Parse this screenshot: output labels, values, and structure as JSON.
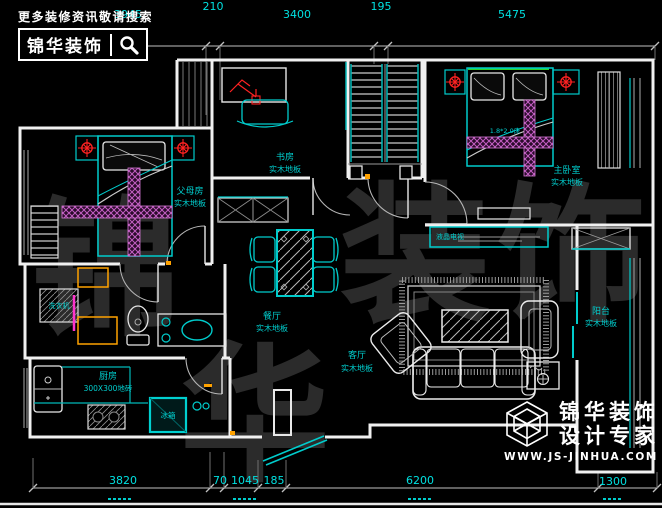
{
  "branding_top": {
    "tagline": "更多装修资讯敬请搜索",
    "logo_name": "锦华装饰"
  },
  "watermark": {
    "chars": [
      "锦",
      "华",
      "装",
      "饰"
    ]
  },
  "dimensions": {
    "top": [
      "3945",
      "210",
      "3400",
      "195",
      "5475"
    ],
    "bottom": [
      "3820",
      "70",
      "1045",
      "185",
      "6200",
      "1300"
    ]
  },
  "rooms": {
    "parents": {
      "name": "父母房",
      "floor": "实木地板"
    },
    "study": {
      "name": "书房",
      "floor": "实木地板"
    },
    "master": {
      "name": "主卧室",
      "floor": "实木地板",
      "bed_size": "1.8*2.0床"
    },
    "dining": {
      "name": "餐厅",
      "floor": "实木地板"
    },
    "living": {
      "name": "客厅",
      "floor": "实木地板"
    },
    "balcony": {
      "name": "阳台",
      "floor": "实木地板"
    },
    "kitchen": {
      "name": "厨房",
      "floor": "300X300地砖"
    }
  },
  "fixtures": {
    "tv": "液晶电视",
    "washer": "洗衣机",
    "fridge": "冰箱"
  },
  "branding_bottom": {
    "company": "锦华装饰",
    "slogan": "设计专家",
    "website": "WWW.JS-JINHUA.COM"
  },
  "colors": {
    "background": "#000000",
    "wall_white": "#f0f0f0",
    "line_cyan": "#00cccc",
    "dimension_text": "#00e0e0",
    "light_red": "#ff2222",
    "hatch_magenta": "#c45fc4",
    "accent_orange": "#ffa200",
    "headboard_green": "#2bd42b",
    "watermark_gray": "#2b2b2b"
  }
}
